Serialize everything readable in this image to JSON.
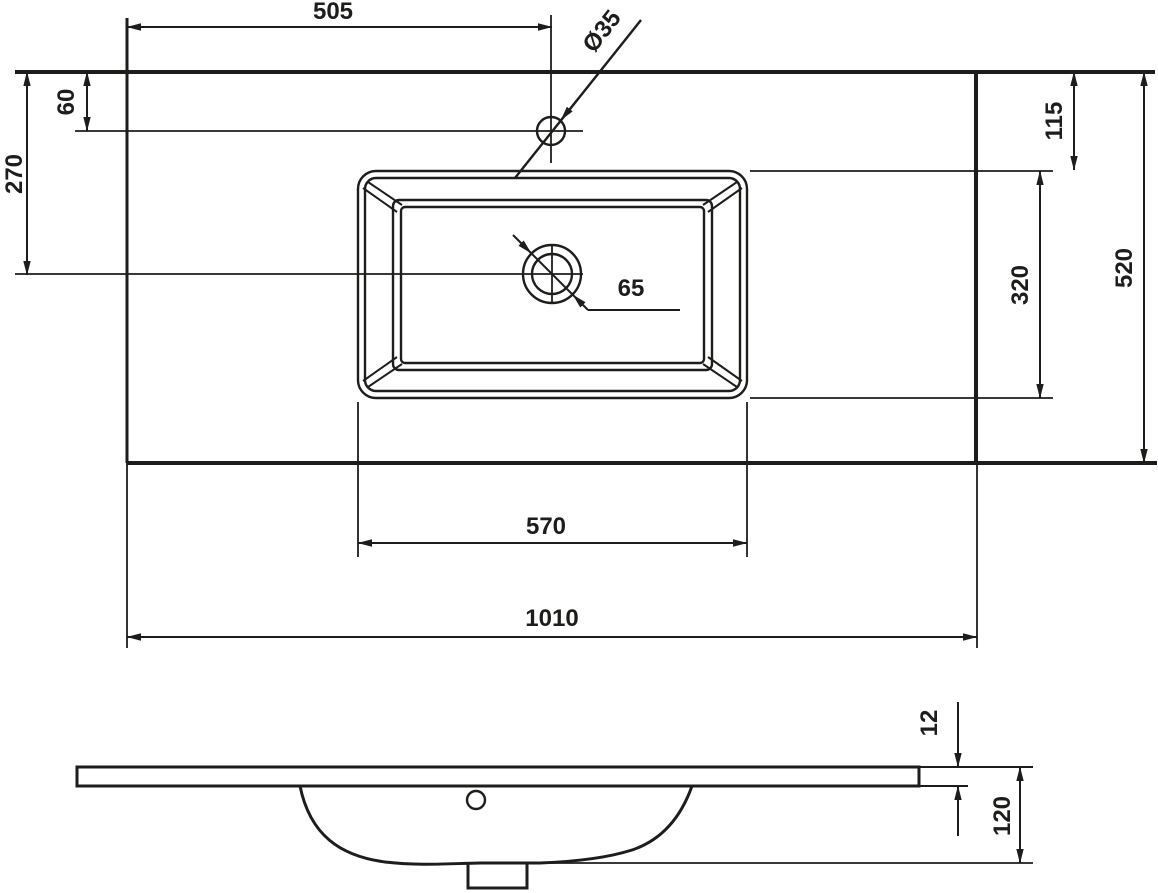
{
  "page": {
    "background_color": "#ffffff",
    "line_color": "#1d1d1b",
    "description": "Technical dimensional drawing of a rectangular washbasin countertop, top view and side profile view"
  },
  "top_view": {
    "labels": {
      "faucet_offset_from_left": "505",
      "faucet_offset_from_back_edge": "60",
      "drain_offset_from_back_edge": "270",
      "faucet_hole_diameter": "Ø35",
      "drain_hole_diameter": "65",
      "basin_offset_from_back_edge": "115",
      "basin_inner_depth": "320",
      "countertop_total_depth": "520",
      "basin_outer_width": "570",
      "countertop_total_width": "1010"
    }
  },
  "side_view": {
    "labels": {
      "countertop_edge_thickness": "12",
      "total_basin_height": "120"
    }
  }
}
